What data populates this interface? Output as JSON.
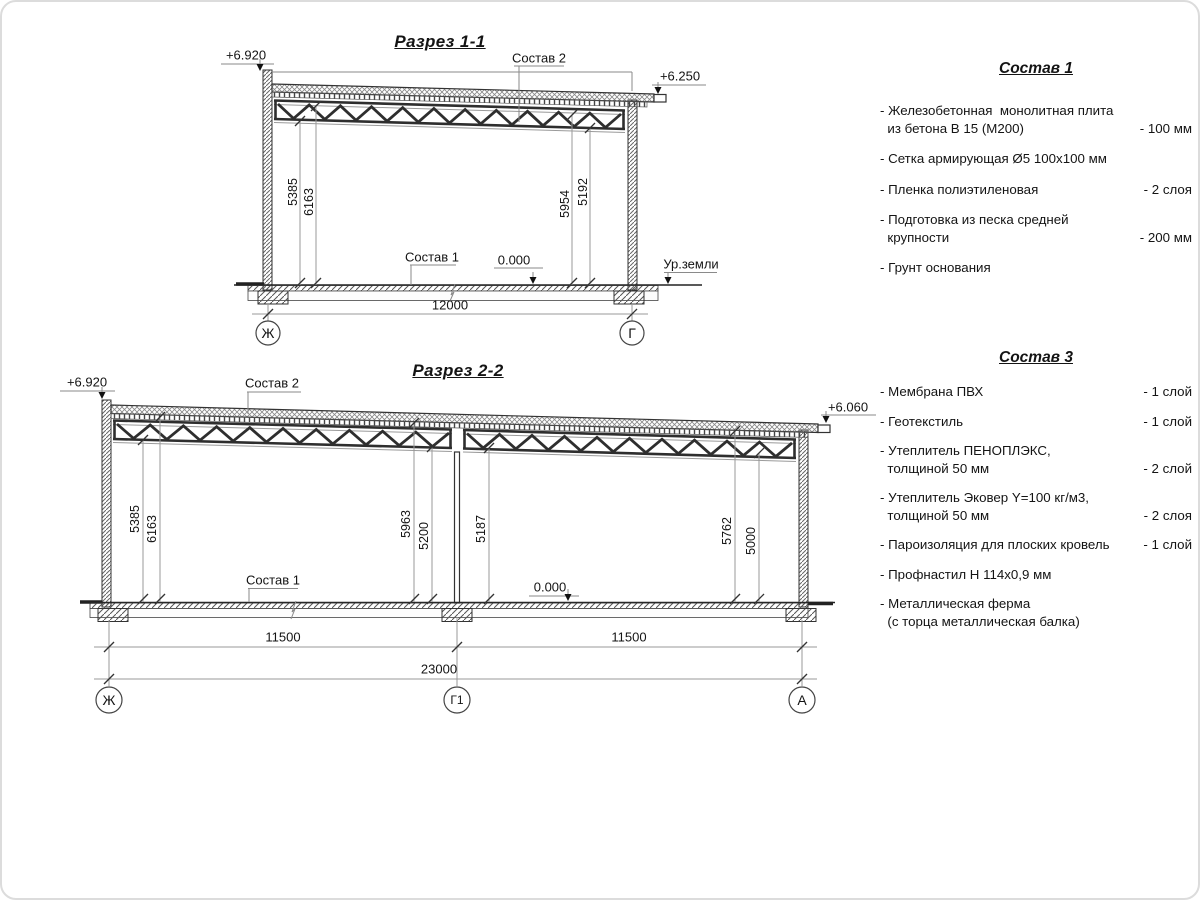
{
  "s1": {
    "title": "Разрез 1-1",
    "elev_left": "+6.920",
    "elev_right": "+6.250",
    "composition_roof": "Состав 2",
    "composition_floor": "Состав 1",
    "zero_level": "0.000",
    "ground_level": "Ур.земли",
    "dim_left_1": "5385",
    "dim_left_2": "6163",
    "dim_right_1": "5954",
    "dim_right_2": "5192",
    "span": "12000",
    "axis_left": "Ж",
    "axis_right": "Г"
  },
  "s2": {
    "title": "Разрез 2-2",
    "elev_left": "+6.920",
    "elev_right": "+6.060",
    "composition_roof": "Состав 2",
    "composition_floor": "Состав 1",
    "zero_level": "0.000",
    "dim_1": "5385",
    "dim_2": "6163",
    "dim_3": "5963",
    "dim_4": "5200",
    "dim_5": "5187",
    "dim_6": "5762",
    "dim_7": "5000",
    "span_left": "11500",
    "span_right": "11500",
    "span_total": "23000",
    "axis_left": "Ж",
    "axis_mid": "Г1",
    "axis_right": "А"
  },
  "comp1": {
    "title": "Состав 1",
    "items": [
      {
        "text": "- Железобетонная  монолитная плита\n  из бетона В 15 (М200)",
        "value": "- 100 мм"
      },
      {
        "text": "- Сетка армирующая Ø5 100х100 мм",
        "value": ""
      },
      {
        "text": "- Пленка полиэтиленовая",
        "value": "-  2 слоя"
      },
      {
        "text": "- Подготовка из песка средней\n  крупности",
        "value": "- 200 мм"
      },
      {
        "text": "- Грунт основания",
        "value": ""
      }
    ]
  },
  "comp3": {
    "title": "Состав 3",
    "items": [
      {
        "text": "- Мембрана ПВХ",
        "value": "- 1 слой"
      },
      {
        "text": "- Геотекстиль",
        "value": "- 1 слой"
      },
      {
        "text": "- Утеплитель ПЕНОПЛЭКС,\n  толщиной 50 мм",
        "value": "- 2 слой"
      },
      {
        "text": "- Утеплитель Эковер Y=100 кг/м3,\n  толщиной 50 мм",
        "value": "- 2 слоя"
      },
      {
        "text": "- Пароизоляция для плоских кровель",
        "value": "- 1 слой"
      },
      {
        "text": "- Профнастил Н 114х0,9 мм",
        "value": ""
      },
      {
        "text": "- Металлическая ферма\n  (с торца металлическая балка)",
        "value": ""
      }
    ]
  }
}
